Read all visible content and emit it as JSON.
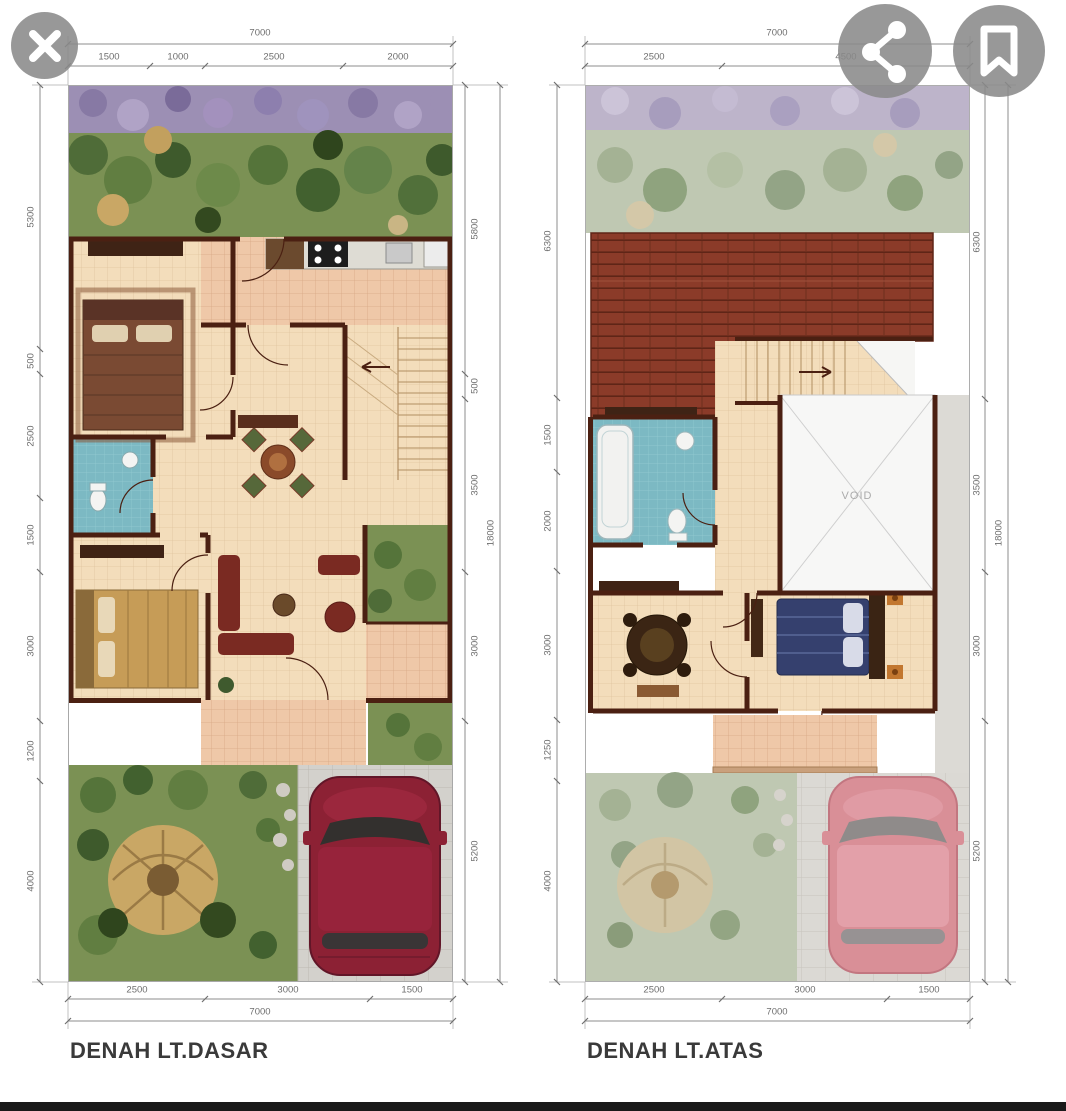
{
  "viewer": {
    "close_icon": "close-x",
    "share_icon": "share-nodes",
    "bookmark_icon": "bookmark-outline",
    "button_color": "#8a8a8a",
    "bottom_bar_color": "#1a1a1a"
  },
  "plans": [
    {
      "label": "DENAH LT.DASAR",
      "dims": {
        "top_total": "7000",
        "top_segments": [
          "1500",
          "1000",
          "2500",
          "2000"
        ],
        "left_segments": [
          "5300",
          "500",
          "2500",
          "1500",
          "3000",
          "1200",
          "4000"
        ],
        "right_segments": [
          "5800",
          "500",
          "3500",
          "3000",
          "5200"
        ],
        "side_total": "18000",
        "bottom_segments": [
          "2500",
          "3000",
          "1500"
        ],
        "bottom_total": "7000"
      }
    },
    {
      "label": "DENAH LT.ATAS",
      "void_label": "VOID",
      "dims": {
        "top_total": "7000",
        "top_segments": [
          "2500",
          "4500"
        ],
        "left_segments": [
          "6300",
          "1500",
          "2000",
          "3000",
          "1250",
          "4000"
        ],
        "right_segments": [
          "6300",
          "3500",
          "3000",
          "5200"
        ],
        "side_total": "18000",
        "bottom_segments": [
          "2500",
          "3000",
          "1500"
        ],
        "bottom_total": "7000"
      }
    }
  ],
  "colors": {
    "wall": "#4b2012",
    "floor_tile": "#f3ddbb",
    "salmon_tile": "#efc8a8",
    "bath_tile": "#7cb9c3",
    "roof": "#8b3b29",
    "garden": "#7b9154",
    "garden_faded": "#bfc8b2",
    "car_ground_floor": "#8c2134",
    "car_upper_floor": "#d98f97",
    "paving": "#d3d1cc",
    "dim_text": "#6e6e6e",
    "title_text": "#3a3a3a"
  }
}
